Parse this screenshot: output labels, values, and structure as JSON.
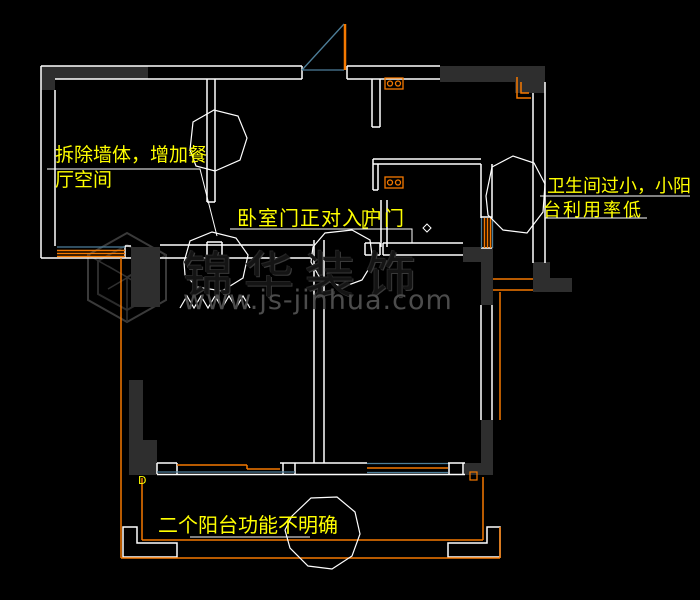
{
  "canvas": {
    "width": 700,
    "height": 600,
    "background": "#000000"
  },
  "watermark": {
    "brand": "锦华装饰",
    "url": "www.js-jinhua.com",
    "logo_icon": "hexagon-cube-logo",
    "color_brand": "#141414",
    "color_url": "#4c4c4c"
  },
  "annotations": {
    "dining": {
      "line1": "拆除墙体，增加餐",
      "line2": "厅空间"
    },
    "bedroom_door": {
      "text": "卧室门正对入户门"
    },
    "bathroom": {
      "line1": "卫生间过小，小阳",
      "line2": "台利用率低"
    },
    "balcony": {
      "text": "二个阳台功能不明确"
    },
    "color": "#ffff00"
  },
  "symbols": {
    "balcony_point_label": "D",
    "gas_meter_icon": "orange rectangle with two circles",
    "corner_pipe_icon": "orange L-bracket",
    "switch_icon": "yellow bracket",
    "revision_cloud": "white polygon cloud"
  },
  "colors": {
    "wall_line": "#ffffff",
    "wall_fill": "#2e2e2e",
    "window_frame": "#f57900",
    "window_glass": "#4d7e99",
    "annotation": "#ffff00",
    "balcony_rail": "#f57900"
  }
}
